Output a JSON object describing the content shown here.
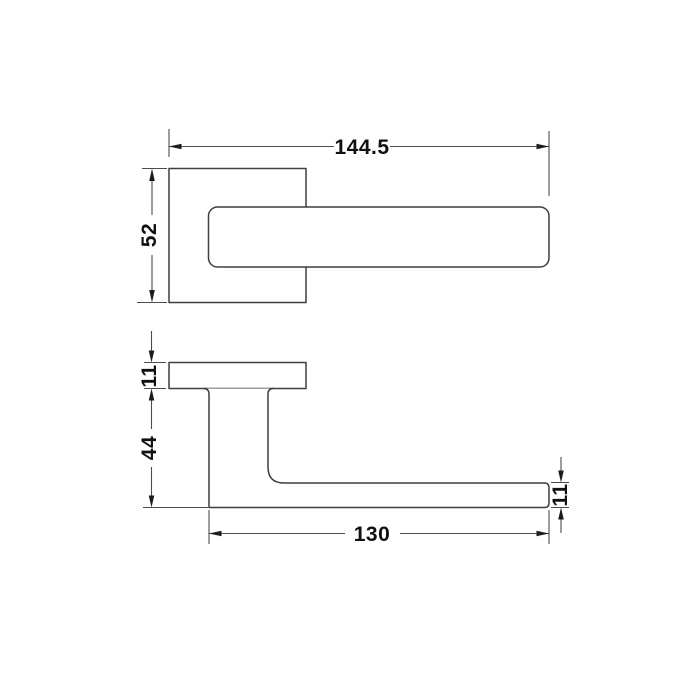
{
  "drawing": {
    "kind": "technical-dimension-drawing",
    "subject": "door-lever-handle-on-square-rose",
    "units": "mm",
    "top_view": {
      "overall_length": "144.5",
      "rose_width": "52"
    },
    "side_view": {
      "rose_thickness": "11",
      "handle_height": "44",
      "lever_length": "130",
      "lever_thickness": "11"
    },
    "colors": {
      "background": "#ffffff",
      "object_line": "#3f3f3f",
      "dimension_line": "#4d4d4d",
      "text": "#111111",
      "arrow": "#1c1c1c"
    }
  }
}
